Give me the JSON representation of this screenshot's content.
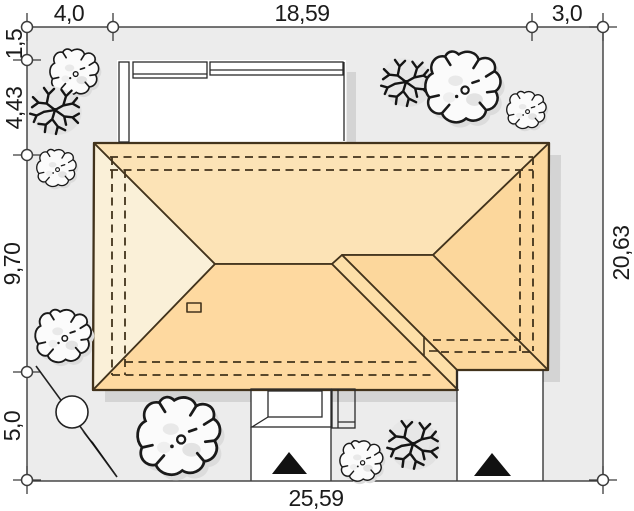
{
  "meta": {
    "drawing_type": "house site plan with roof view",
    "units": "meters (comma decimal)"
  },
  "dims": {
    "top": [
      "4,0",
      "18,59",
      "3,0"
    ],
    "left": [
      "1,5",
      "4,43",
      "9,70",
      "5,0"
    ],
    "right": [
      "20,63"
    ],
    "bottom": [
      "25,59"
    ]
  },
  "colors": {
    "page_bg": "#ffffff",
    "plot_bg": "#ececec",
    "plot_border": "#3c3c3c",
    "roof_north": "#fce3b6",
    "roof_south": "#fed9a0",
    "roof_west": "#faf0d8",
    "roof_east": "#fcd79c",
    "roof_band": "#fddfa8",
    "roof_line": "#42331c",
    "shadow": "#d4d4d4",
    "structure_line": "#2a2a2a",
    "marker_black": "#111111",
    "text": "#1b1b1b"
  },
  "trees": {
    "items": [
      {
        "type": "bush",
        "x": 75,
        "y": 72,
        "s": 0.68
      },
      {
        "type": "branch",
        "x": 55,
        "y": 110,
        "s": 0.92
      },
      {
        "type": "bush",
        "x": 57,
        "y": 168,
        "s": 0.55
      },
      {
        "type": "bush",
        "x": 64,
        "y": 336,
        "s": 0.78
      },
      {
        "type": "bush",
        "x": 180,
        "y": 436,
        "s": 1.15
      },
      {
        "type": "bush",
        "x": 362,
        "y": 461,
        "s": 0.6
      },
      {
        "type": "branch",
        "x": 413,
        "y": 444,
        "s": 0.95
      },
      {
        "type": "branch",
        "x": 406,
        "y": 82,
        "s": 0.92
      },
      {
        "type": "bush",
        "x": 464,
        "y": 87,
        "s": 1.05
      },
      {
        "type": "bush",
        "x": 527,
        "y": 110,
        "s": 0.55
      }
    ]
  },
  "features": {
    "north_arrow": "compass line with circle and black point",
    "entrance_triangles": 2,
    "chimney": 1
  }
}
